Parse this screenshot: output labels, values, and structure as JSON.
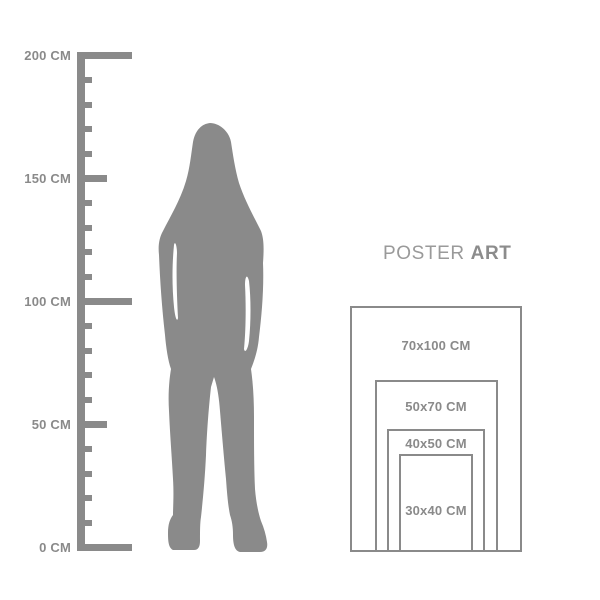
{
  "colors": {
    "background": "#ffffff",
    "gray": "#8a8a8a",
    "label_text": "#8a8a8a",
    "brand_regular": "#9a9a9a",
    "brand_bold": "#8c8c8c"
  },
  "ruler": {
    "unit": "CM",
    "min_cm": 0,
    "max_cm": 200,
    "minor_step_cm": 10,
    "labels": [
      {
        "cm": 200,
        "text": "200 CM"
      },
      {
        "cm": 150,
        "text": "150 CM"
      },
      {
        "cm": 100,
        "text": "100 CM"
      },
      {
        "cm": 50,
        "text": "50 CM"
      },
      {
        "cm": 0,
        "text": "0 CM"
      }
    ]
  },
  "figure": {
    "type": "standing-woman-silhouette",
    "approx_height_cm": 173
  },
  "brand": {
    "word_regular": "POSTER",
    "word_bold": "ART"
  },
  "poster_sizes": [
    {
      "label": "70x100 CM",
      "width_cm": 70,
      "height_cm": 100
    },
    {
      "label": "50x70 CM",
      "width_cm": 50,
      "height_cm": 70
    },
    {
      "label": "40x50 CM",
      "width_cm": 40,
      "height_cm": 50
    },
    {
      "label": "30x40 CM",
      "width_cm": 30,
      "height_cm": 40
    }
  ]
}
